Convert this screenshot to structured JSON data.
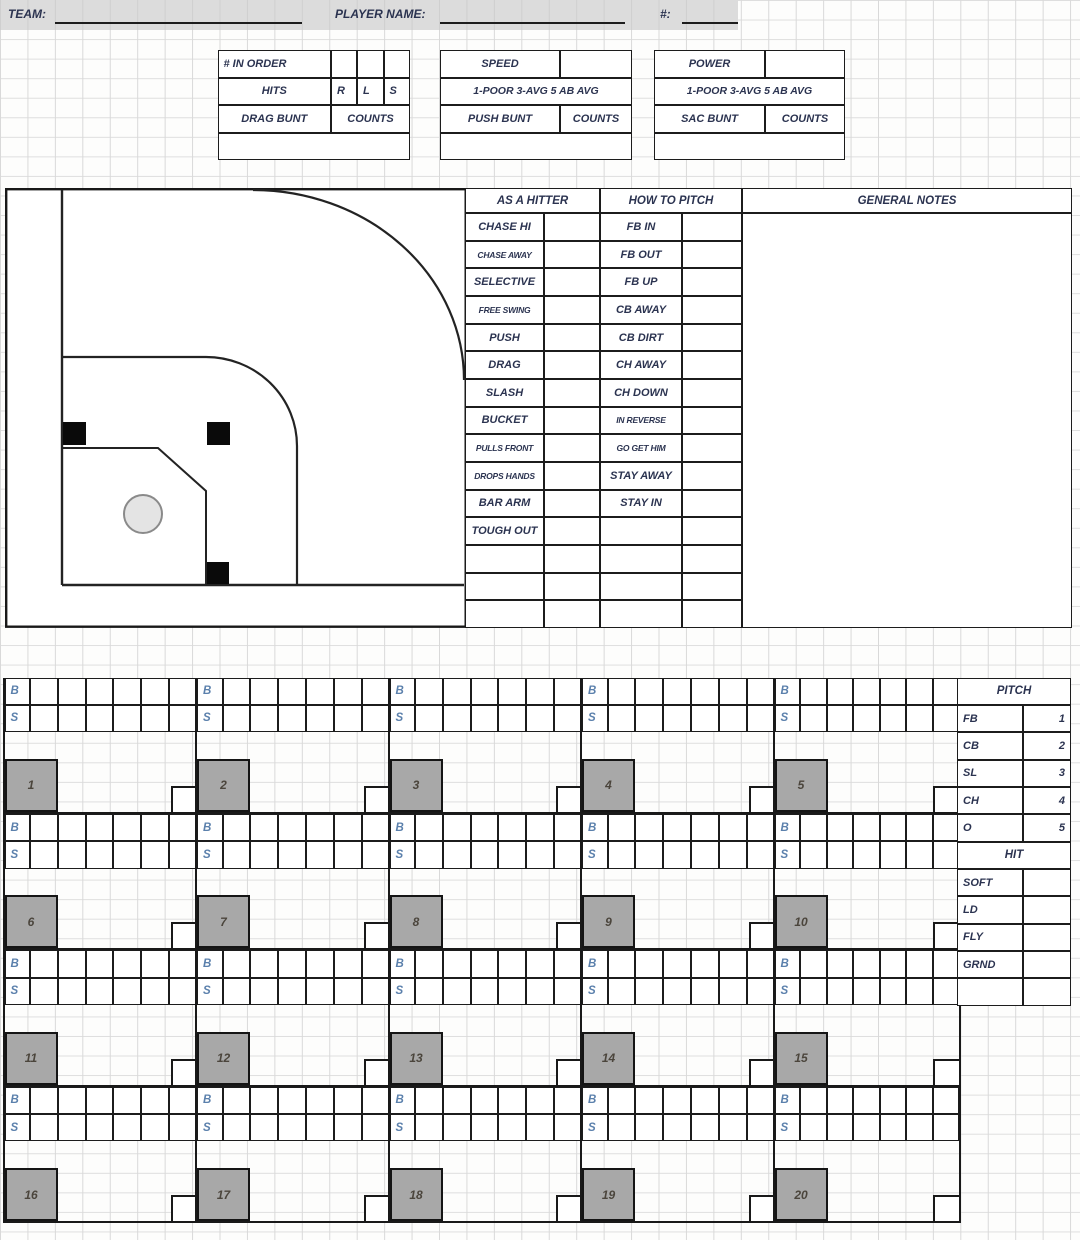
{
  "header": {
    "team_label": "TEAM:",
    "player_name_label": "PLAYER NAME:",
    "jersey_number_label": "#:"
  },
  "info_boxes": {
    "order_box": {
      "row1": "# IN ORDER",
      "row2_label": "HITS",
      "row2_cells": [
        "R",
        "L",
        "S"
      ],
      "row3_label": "DRAG BUNT",
      "row3_value": "COUNTS"
    },
    "speed_box": {
      "row1": "SPEED",
      "row2": "1-POOR 3-AVG 5 AB AVG",
      "row3_label": "PUSH BUNT",
      "row3_value": "COUNTS"
    },
    "power_box": {
      "row1": "POWER",
      "row2": "1-POOR 3-AVG 5 AB AVG",
      "row3_label": "SAC BUNT",
      "row3_value": "COUNTS"
    }
  },
  "scouting": {
    "hitter_title": "AS A HITTER",
    "hitter_rows": [
      "CHASE HI",
      "CHASE AWAY",
      "SELECTIVE",
      "FREE SWING",
      "PUSH",
      "DRAG",
      "SLASH",
      "BUCKET",
      "PULLS FRONT",
      "DROPS HANDS",
      "BAR ARM",
      "TOUGH OUT",
      "",
      "",
      ""
    ],
    "pitch_title": "HOW TO PITCH",
    "pitch_rows": [
      "FB IN",
      "FB OUT",
      "FB UP",
      "CB AWAY",
      "CB DIRT",
      "CH AWAY",
      "CH DOWN",
      "IN REVERSE",
      "GO GET HIM",
      "STAY AWAY",
      "STAY IN",
      "",
      "",
      "",
      ""
    ],
    "notes_title": "GENERAL NOTES"
  },
  "at_bat_grid": {
    "ball_label": "B",
    "strike_label": "S",
    "pitch_cells_per_row": 6,
    "at_bat_numbers": [
      1,
      2,
      3,
      4,
      5,
      6,
      7,
      8,
      9,
      10,
      11,
      12,
      13,
      14,
      15,
      16,
      17,
      18,
      19,
      20
    ]
  },
  "legend": {
    "pitch_title": "PITCH",
    "pitch_types": [
      {
        "label": "FB",
        "code": "1"
      },
      {
        "label": "CB",
        "code": "2"
      },
      {
        "label": "SL",
        "code": "3"
      },
      {
        "label": "CH",
        "code": "4"
      },
      {
        "label": "O",
        "code": "5"
      }
    ],
    "hit_title": "HIT",
    "hit_types": [
      "SOFT",
      "LD",
      "FLY",
      "GRND"
    ]
  },
  "colors": {
    "border": "#1c1c1c",
    "label_text": "#2b3350",
    "ball_strike_text": "#5b80ac",
    "at_bat_box_fill": "#a8a8a8",
    "header_bar_bg": "#dcdcdc",
    "gridline": "#d9d9d9"
  }
}
